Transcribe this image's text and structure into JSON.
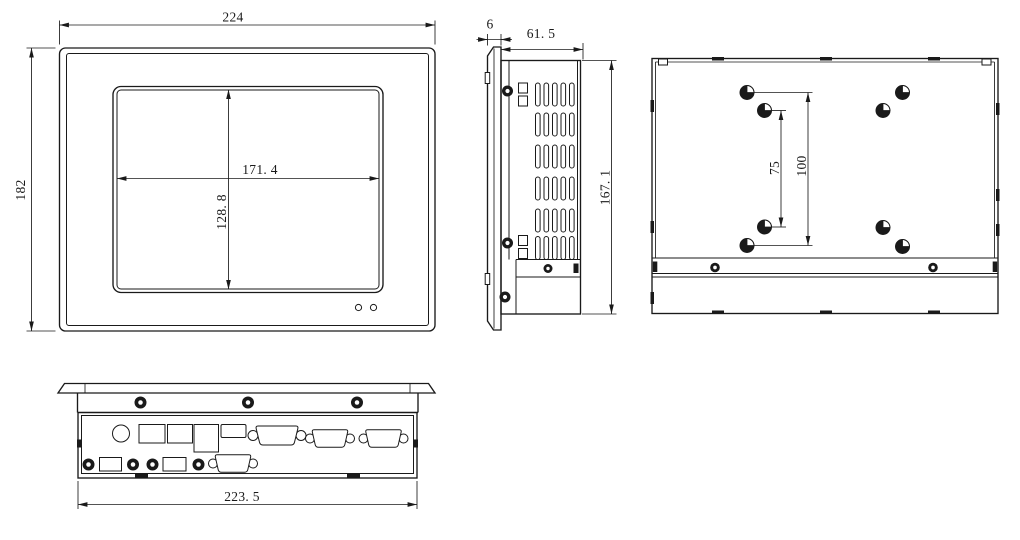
{
  "colors": {
    "line": "#1a1a1a",
    "background": "#ffffff"
  },
  "views": {
    "front": {
      "overall_width": "224",
      "overall_height": "182",
      "display_width": "171. 4",
      "display_height": "128. 8"
    },
    "side": {
      "bezel_thickness": "6",
      "chassis_depth": "61. 5",
      "chassis_height": "167. 1"
    },
    "rear": {
      "vesa_pitch_inner": "75",
      "vesa_pitch_outer": "100"
    },
    "bottom": {
      "chassis_width": "223. 5"
    }
  }
}
